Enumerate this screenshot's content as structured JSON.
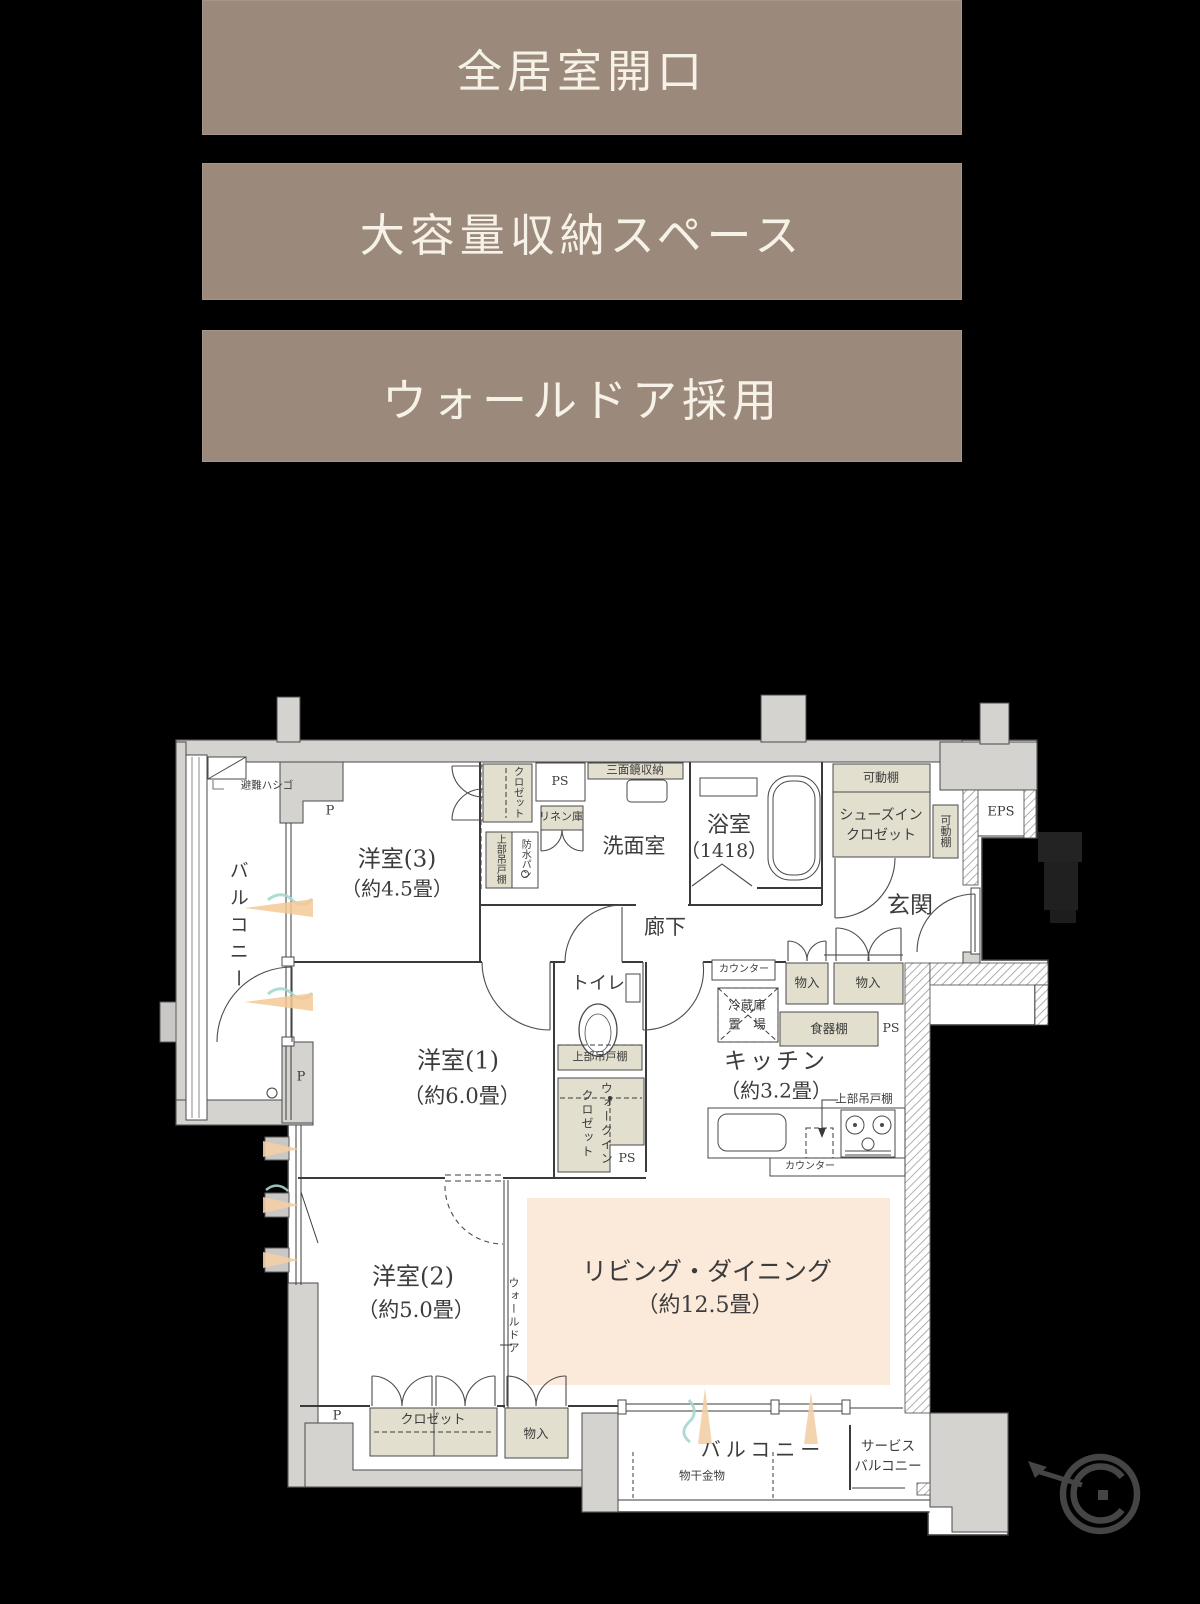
{
  "banners": [
    {
      "label": "全居室開口"
    },
    {
      "label": "大容量収納スペース"
    },
    {
      "label": "ウォールドア採用"
    }
  ],
  "colors": {
    "background": "#000000",
    "banner": "#9b897b",
    "banner_text": "#f7f2e8",
    "wall_gray": "#d5d3d0",
    "storage_beige": "#e2dfce",
    "living_floor": "#fbe9d9",
    "airflow_teal": "#a6d7cf",
    "airflow_orange": "#f4c997"
  },
  "plan": {
    "yoshitsu3": "洋室(3)",
    "yoshitsu3_size": "（約4.5畳）",
    "yoshitsu1": "洋室(1)",
    "yoshitsu1_size": "（約6.0畳）",
    "yoshitsu2": "洋室(2)",
    "yoshitsu2_size": "（約5.0畳）",
    "ld": "リビング・ダイニング",
    "ld_size": "（約12.5畳）",
    "kitchen": "キッチン",
    "kitchen_size": "（約3.2畳）",
    "bath": "浴室",
    "bath_size": "（1418）",
    "senmen": "洗面室",
    "rouka": "廊下",
    "toilet": "トイレ",
    "genkan": "玄関",
    "balcony": "バルコニー",
    "service_balcony": "サービス\nバルコニー",
    "shoes_in_closet": "シューズイン\nクロゼット",
    "kadou_dana": "可動棚",
    "eps": "EPS",
    "ps": "PS",
    "p": "P",
    "closet": "クロゼット",
    "linen": "リネン庫",
    "joubu_tsuridana": "上部吊戸棚",
    "bousui_pan": "防水パン",
    "sanmenkyo": "三面鏡収納",
    "counter": "カウンター",
    "fridge": "冷蔵庫\n置　場",
    "shokki_dana": "食器棚",
    "monoire": "物入",
    "walk_in_closet": "ウォークイン\nクロゼット",
    "wall_door": "ウォールドア",
    "monohoshi": "物干金物",
    "hinan_hashigo": "避難ハシゴ"
  }
}
